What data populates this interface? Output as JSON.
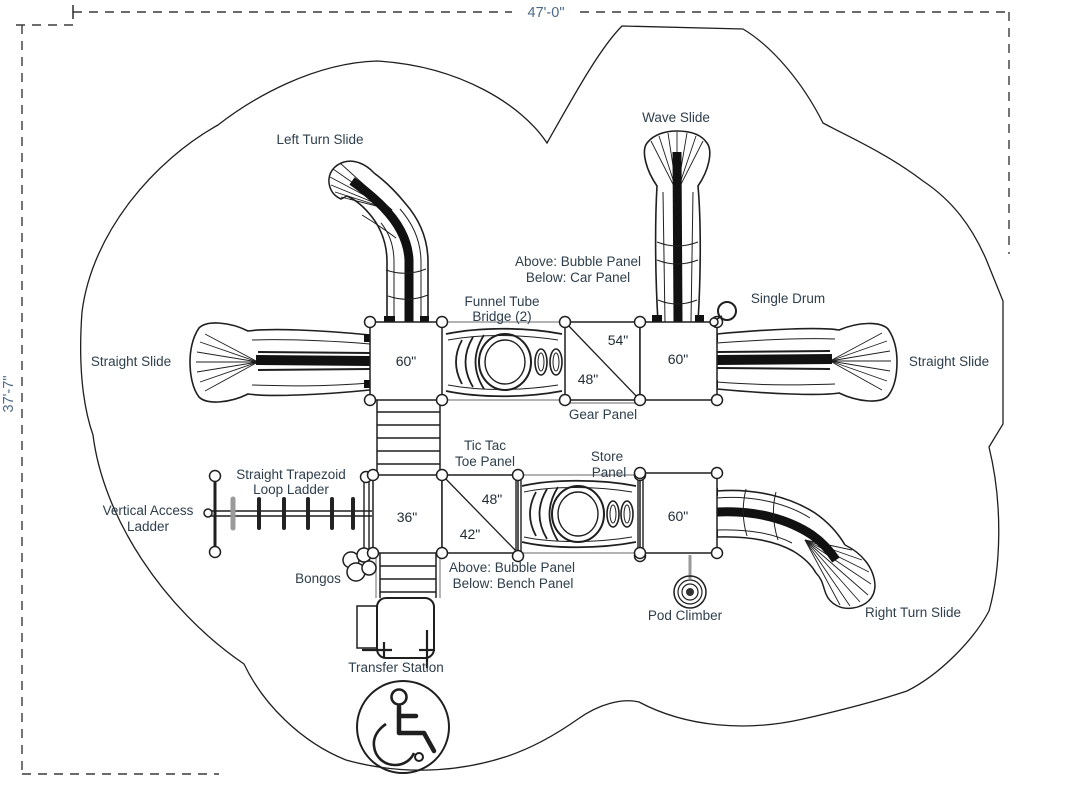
{
  "title": "Playground structure plan view",
  "colors": {
    "line": "#1f1f1f",
    "gray": "#9a9a9a",
    "label_text": "#2d3e4c",
    "dimension_text": "#4c6a85",
    "background": "#ffffff"
  },
  "dimensions": {
    "width": "47'-0\"",
    "height": "37'-7\""
  },
  "labels": {
    "left_turn_slide": "Left Turn Slide",
    "wave_slide": "Wave Slide",
    "panel_bubble_car_line1": "Above: Bubble Panel",
    "panel_bubble_car_line2": "Below: Car Panel",
    "funnel_tube_line1": "Funnel Tube",
    "funnel_tube_line2": "Bridge (2)",
    "single_drum": "Single Drum",
    "straight_slide_left": "Straight Slide",
    "straight_slide_right": "Straight Slide",
    "gear_panel": "Gear Panel",
    "tic_tac_toe_line1": "Tic Tac",
    "tic_tac_toe_line2": "Toe Panel",
    "store_panel_line1": "Store",
    "store_panel_line2": "Panel",
    "vertical_access_line1": "Vertical Access",
    "vertical_access_line2": "Ladder",
    "trapezoid_line1": "Straight Trapezoid",
    "trapezoid_line2": "Loop Ladder",
    "bongos": "Bongos",
    "panel_bubble_bench_line1": "Above: Bubble Panel",
    "panel_bubble_bench_line2": "Below: Bench Panel",
    "transfer_station": "Transfer Station",
    "pod_climber": "Pod Climber",
    "right_turn_slide": "Right Turn Slide"
  },
  "deck_heights": {
    "upper_left": "60\"",
    "upper_mid_a": "54\"",
    "upper_mid_b": "48\"",
    "upper_right": "60\"",
    "lower_left": "36\"",
    "lower_mid_a": "48\"",
    "lower_mid_b": "42\"",
    "lower_right": "60\""
  }
}
